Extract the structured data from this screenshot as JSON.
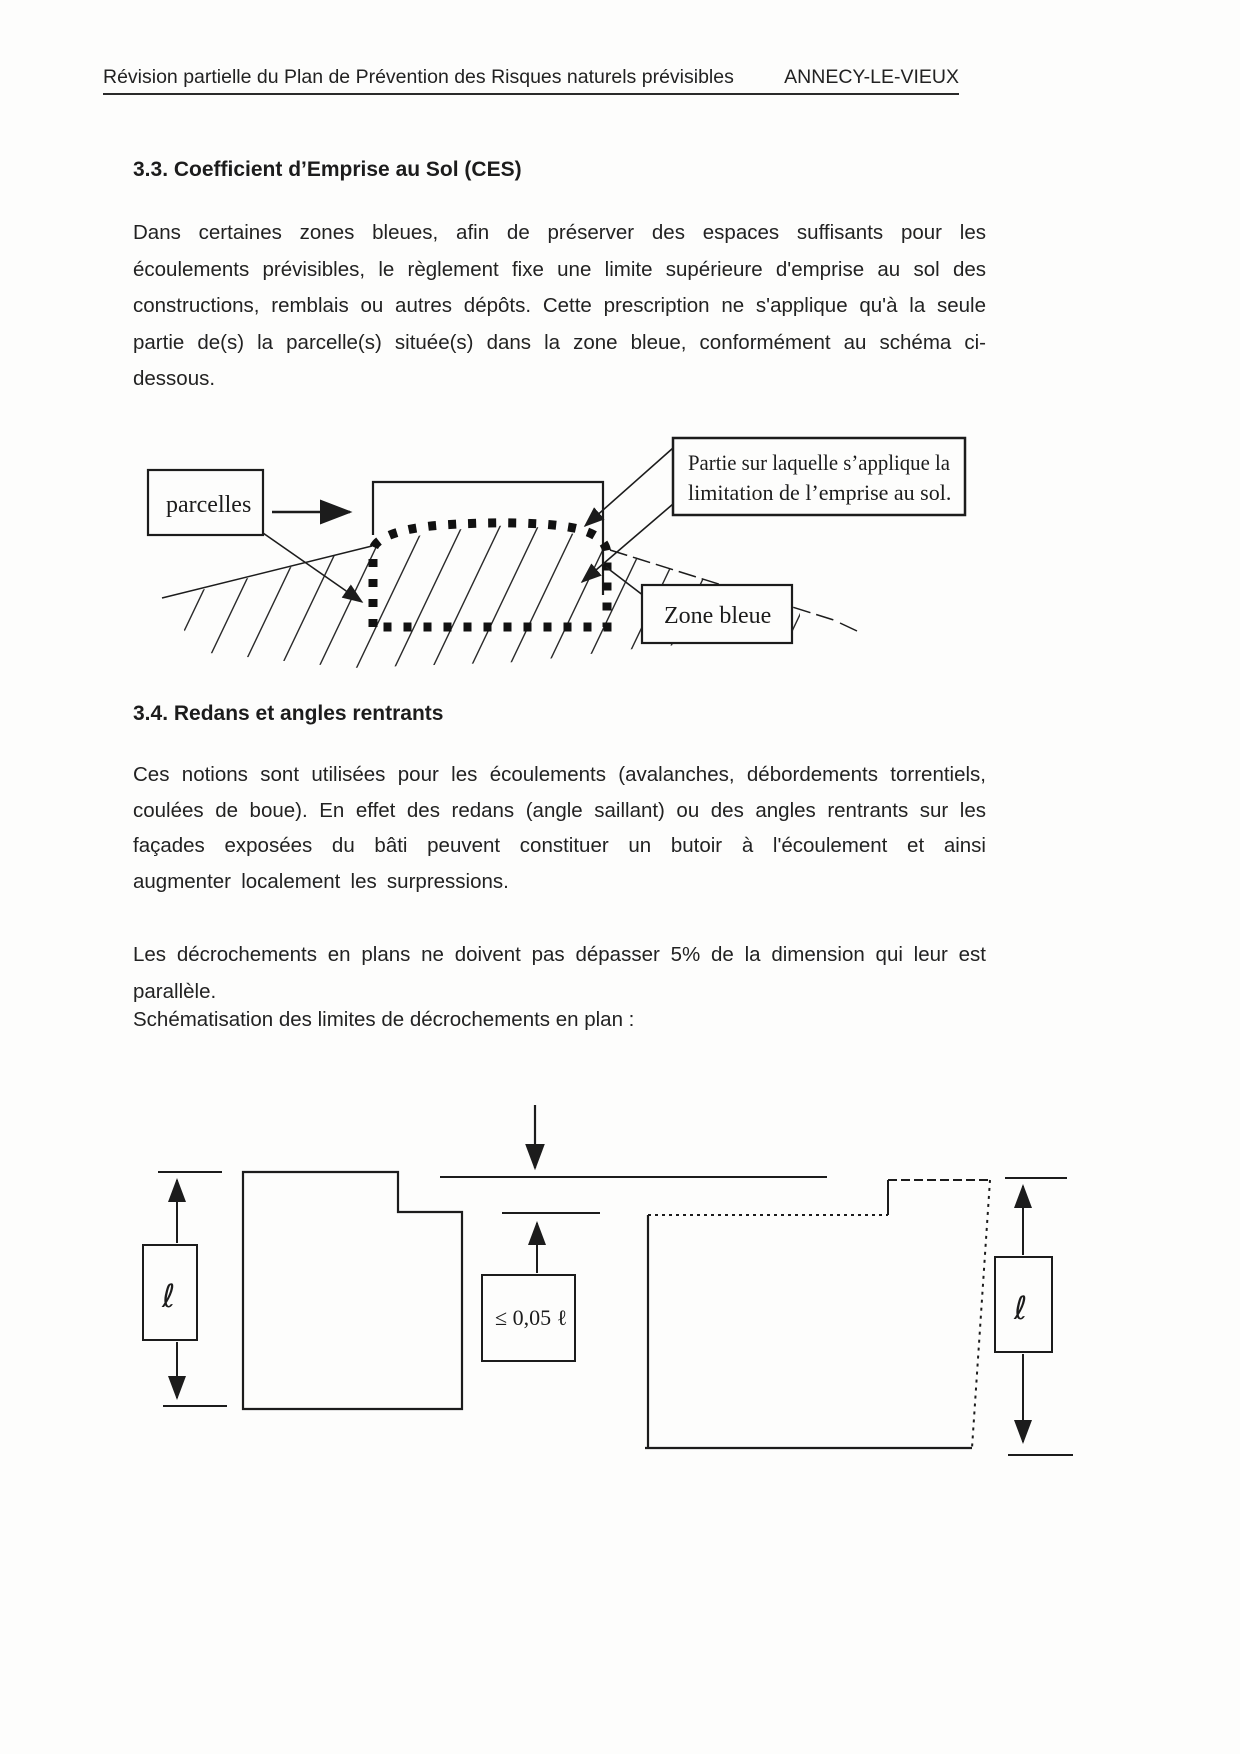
{
  "header": {
    "left": "Révision partielle du Plan de Prévention des Risques naturels prévisibles",
    "right": "ANNECY-LE-VIEUX"
  },
  "section_33": {
    "title": "3.3. Coefficient d’Emprise au Sol (CES)",
    "paragraph": "Dans certaines zones bleues, afin de préserver des espaces suffisants pour les écoulements prévisibles, le règlement fixe une limite supérieure d'emprise au sol des constructions, remblais ou autres dépôts. Cette prescription ne s'applique qu'à la seule partie de(s) la parcelle(s) située(s) dans la zone bleue, conformément au schéma ci-dessous."
  },
  "diagram_zone": {
    "parcelles_label": "parcelles",
    "partie_label_line1": "Partie sur laquelle s’applique la",
    "partie_label_line2": "limitation de l’emprise au sol.",
    "zone_label": "Zone bleue"
  },
  "section_34": {
    "title": "3.4. Redans et angles rentrants",
    "paragraph1": "Ces notions sont utilisées pour les écoulements (avalanches, débordements torrentiels, coulées de boue). En effet des redans (angle saillant) ou des angles rentrants sur les façades exposées du bâti peuvent constituer un butoir à l'écoulement et ainsi augmenter localement les surpressions.",
    "paragraph2": "Les décrochements en plans ne doivent pas dépasser 5% de la dimension qui leur est parallèle.",
    "caption": "Schématisation des limites de décrochements en plan :"
  },
  "diagram_plan": {
    "dim_left_label": "ℓ",
    "dim_right_label": "ℓ",
    "limit_label": "≤ 0,05 ℓ"
  },
  "colors": {
    "ink": "#1c1c1c",
    "paper": "#fdfdfc"
  }
}
